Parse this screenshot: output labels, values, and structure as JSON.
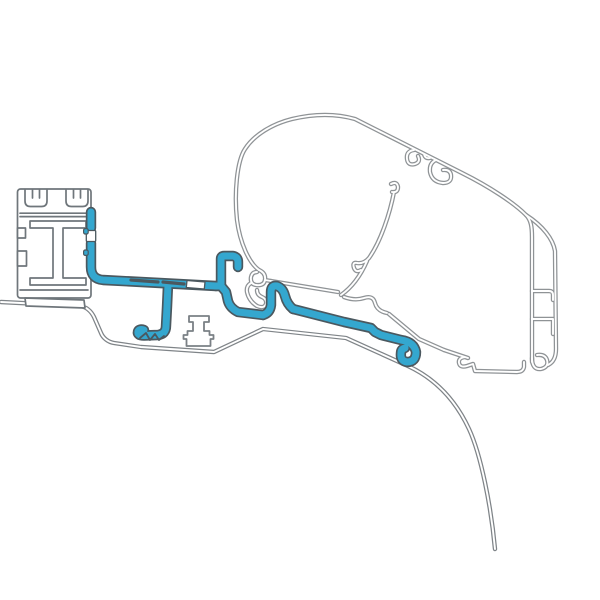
{
  "canvas": {
    "width": 600,
    "height": 600,
    "background_color": "#ffffff"
  },
  "colors": {
    "adapter-fill": "#34a7cf",
    "adapter-outline": "#4b585f",
    "rail-outline": "#6f767b",
    "case-line": "#8f9396",
    "roof-line": "#7f8488",
    "foot-outline": "#7a8085"
  },
  "parts": [
    {
      "name": "awning-rail-profile",
      "style": "grey-outlined-extrusion"
    },
    {
      "name": "adapter-bracket-highlight",
      "style": "blue-filled-band"
    },
    {
      "name": "roof-mount-foot",
      "style": "grey-outlined-block"
    },
    {
      "name": "awning-case-profile",
      "style": "grey-double-line"
    },
    {
      "name": "vehicle-roof-contour",
      "style": "grey-double-line"
    }
  ]
}
